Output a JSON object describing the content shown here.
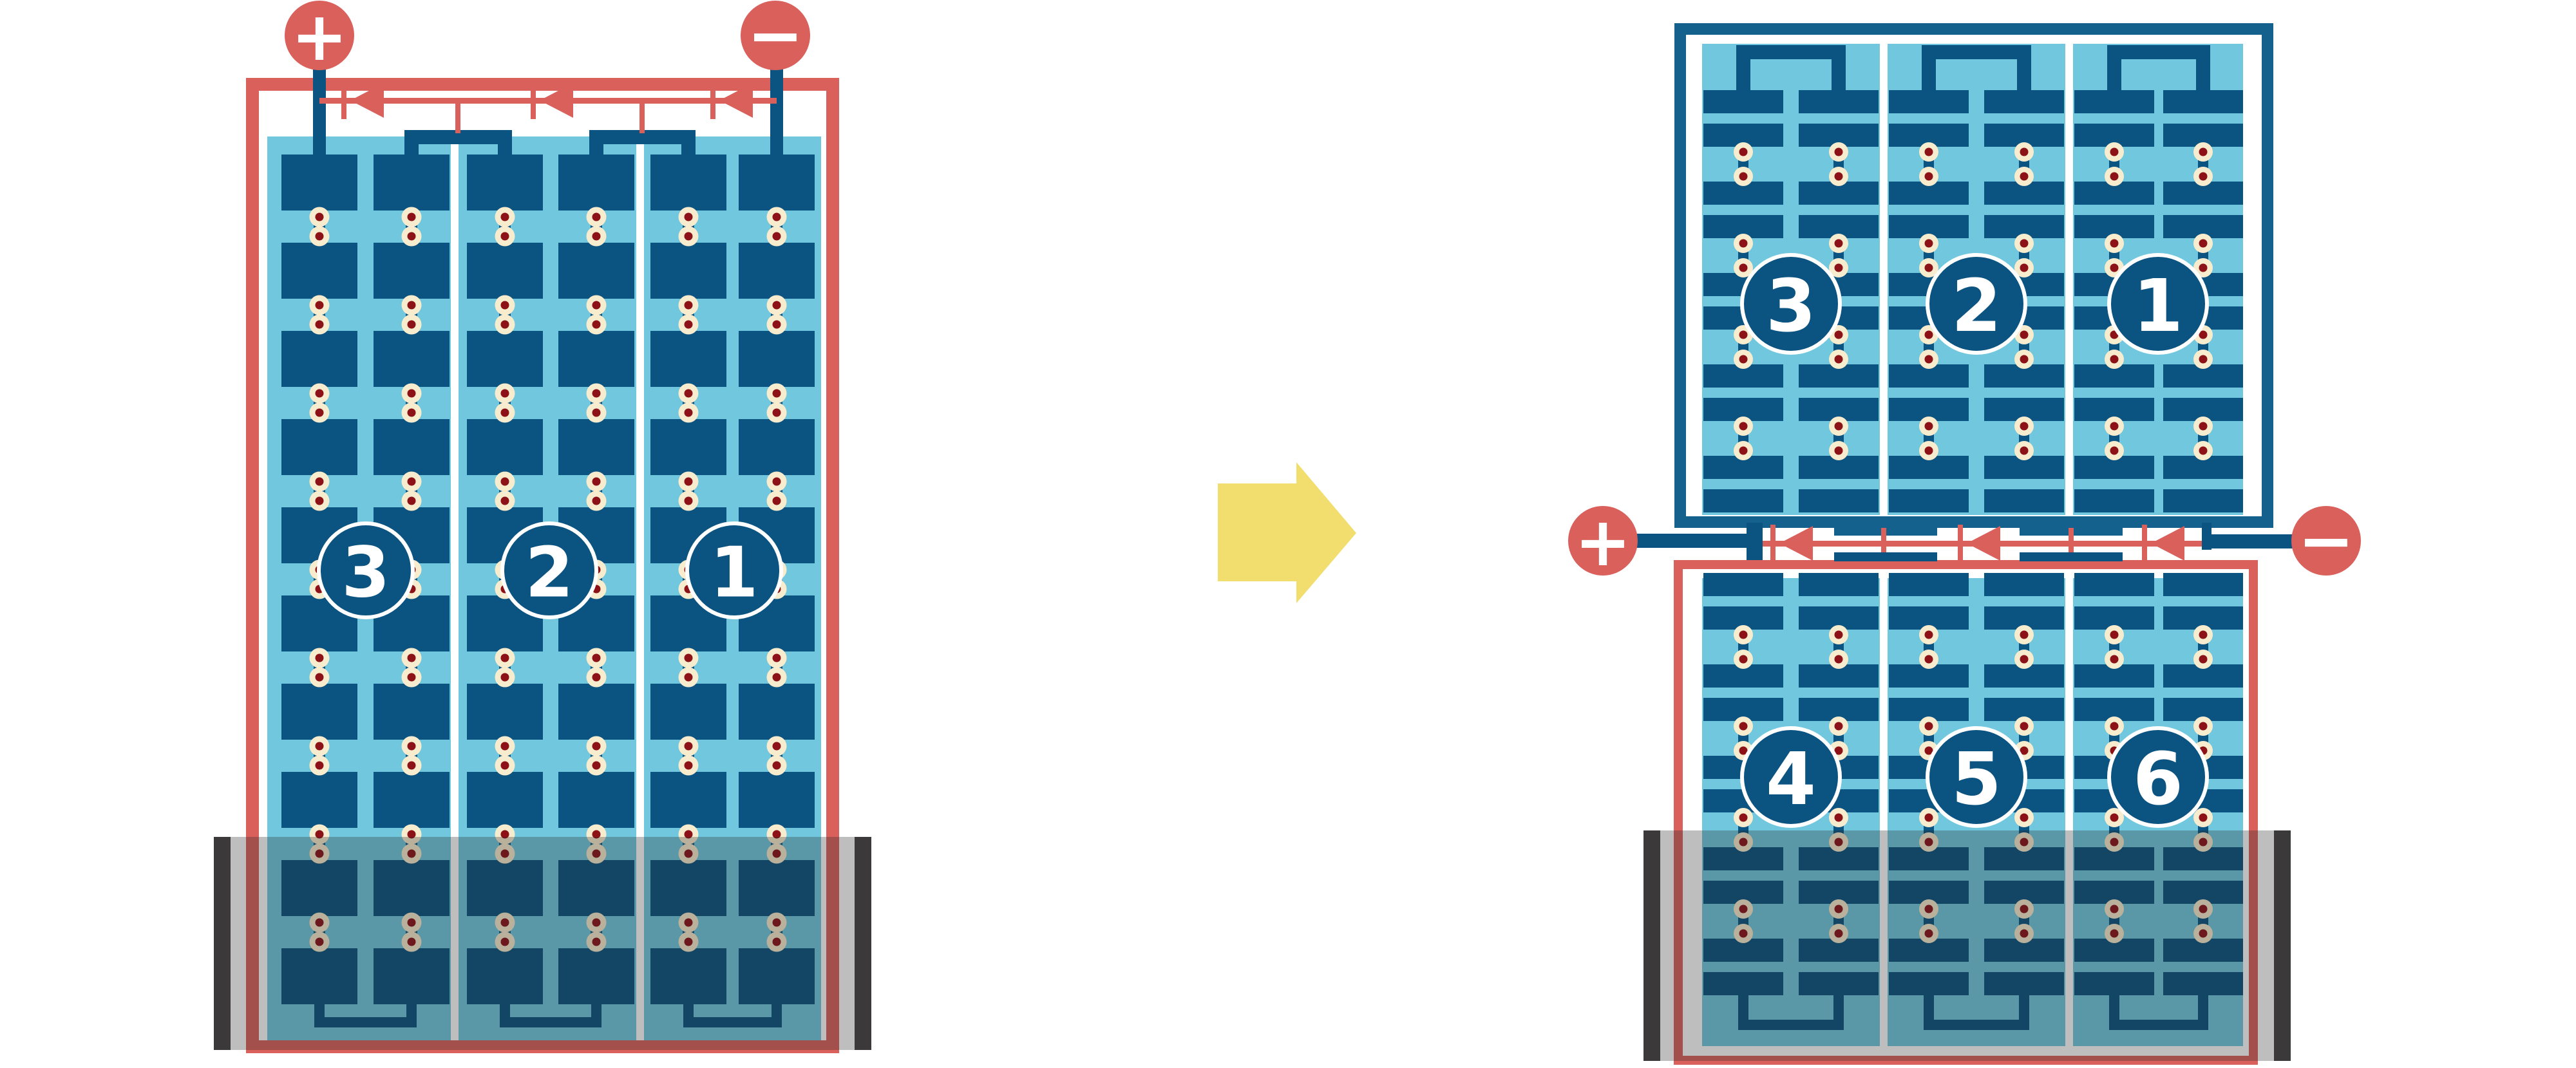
{
  "colors": {
    "red": "#D9605B",
    "blue": "#0B5380",
    "frame_blue": "#15618E",
    "cyan": "#70C7DE",
    "cream": "#F8ECCF",
    "dot_red": "#8C1218",
    "wall": "#3B3939",
    "overlay": "rgba(40,40,40,0.30)",
    "yellow": "#F2DE6E"
  },
  "left_unit": {
    "positive_terminal": "+",
    "negative_terminal": "−",
    "cell_numbers": [
      "3",
      "2",
      "1"
    ]
  },
  "right_unit": {
    "positive_terminal": "+",
    "negative_terminal": "−",
    "upper_cell_numbers": [
      "3",
      "2",
      "1"
    ],
    "lower_cell_numbers": [
      "4",
      "5",
      "6"
    ]
  }
}
